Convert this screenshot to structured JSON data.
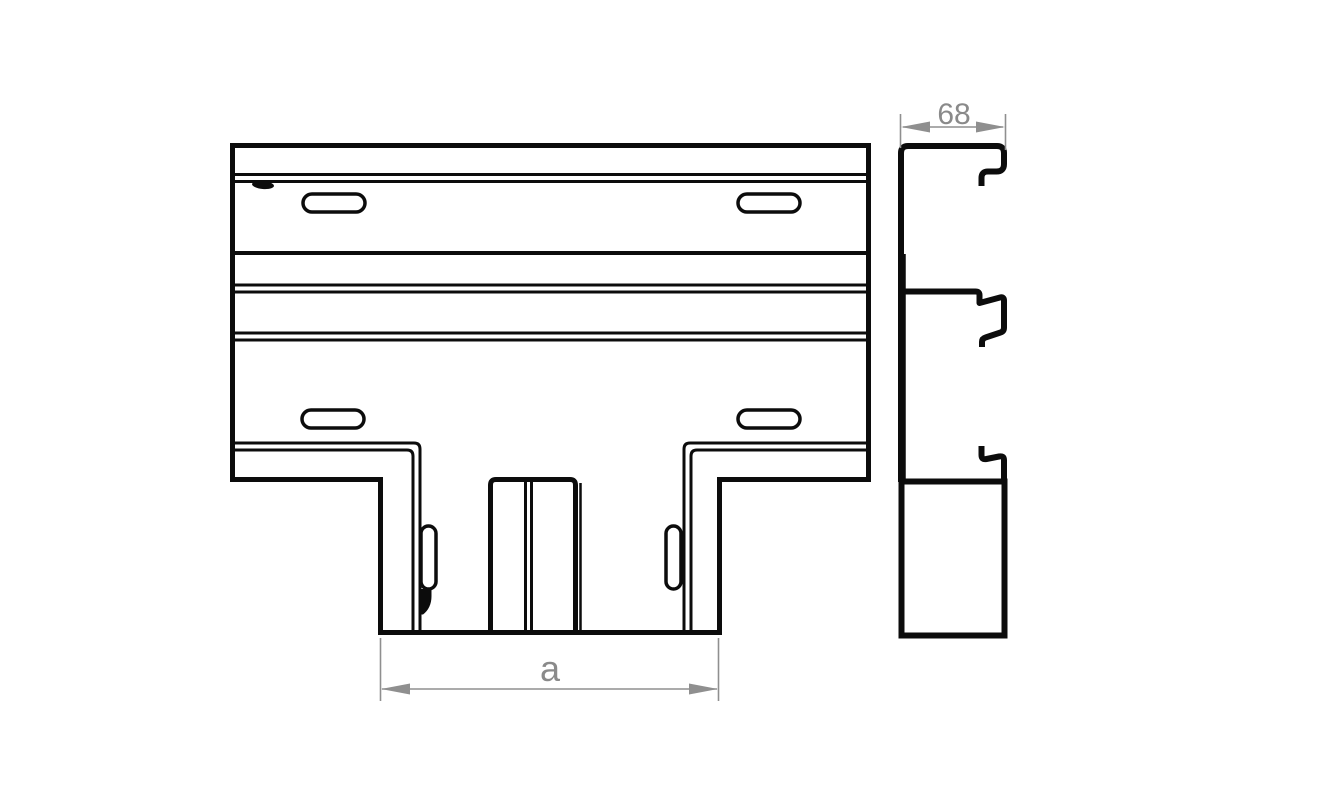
{
  "diagram": {
    "type": "technical-line-drawing",
    "subject": "cable-trunking-tee-piece",
    "dimensions": {
      "profile_width": "68",
      "stem_width_label": "a"
    },
    "colors": {
      "line": "#0c0c0c",
      "dimension": "#8f8f8f",
      "background": "#ffffff"
    }
  }
}
